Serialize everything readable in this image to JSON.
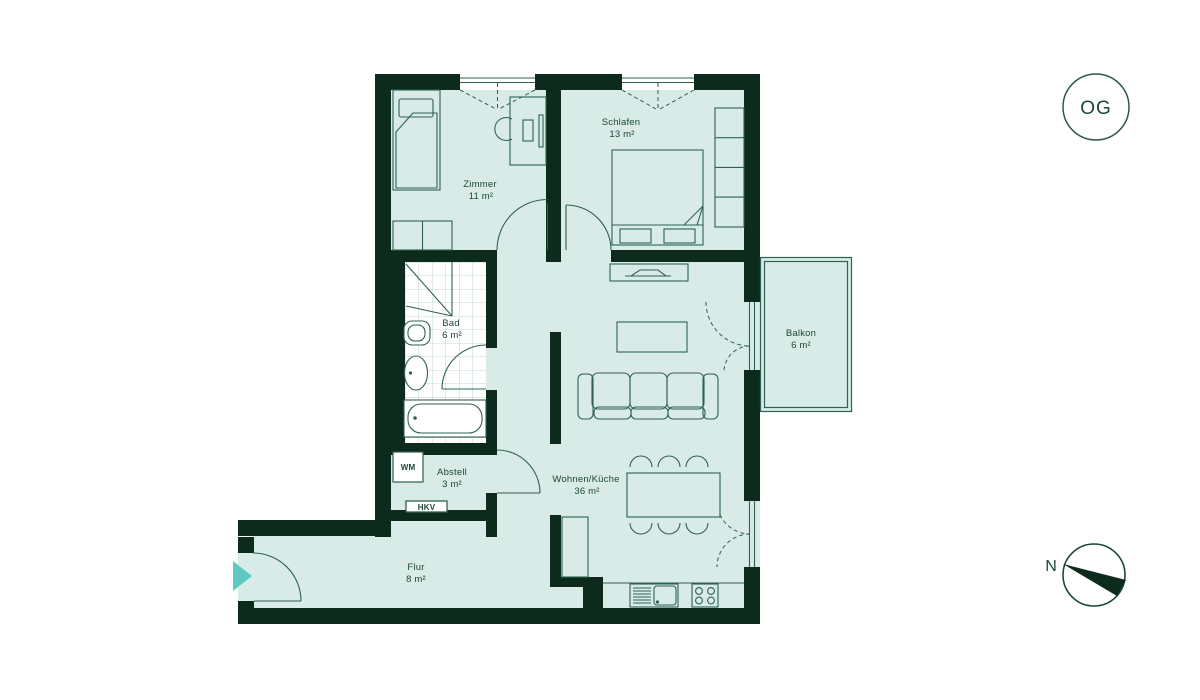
{
  "plan": {
    "floor_badge": "OG",
    "compass_label": "N",
    "rooms": {
      "zimmer": {
        "name": "Zimmer",
        "area": "11 m²"
      },
      "schlafen": {
        "name": "Schlafen",
        "area": "13 m²"
      },
      "bad": {
        "name": "Bad",
        "area": "6 m²"
      },
      "abstell": {
        "name": "Abstell",
        "area": "3 m²"
      },
      "wohnen_kueche": {
        "name": "Wohnen/Küche",
        "area": "36 m²"
      },
      "flur": {
        "name": "Flur",
        "area": "8 m²"
      },
      "balkon": {
        "name": "Balkon",
        "area": "6 m²"
      }
    },
    "fixtures": {
      "washing_machine": "WM",
      "heating_distributor": "HKV"
    }
  },
  "colors": {
    "wall": "#0d2b1d",
    "room_fill": "#d8ebe7",
    "outline": "#2f6152",
    "text": "#1c4638",
    "accent": "#5ec9c0",
    "bad_floor": "#ffffff",
    "tile_grid": "#c3d8d2",
    "background": "#ffffff"
  }
}
